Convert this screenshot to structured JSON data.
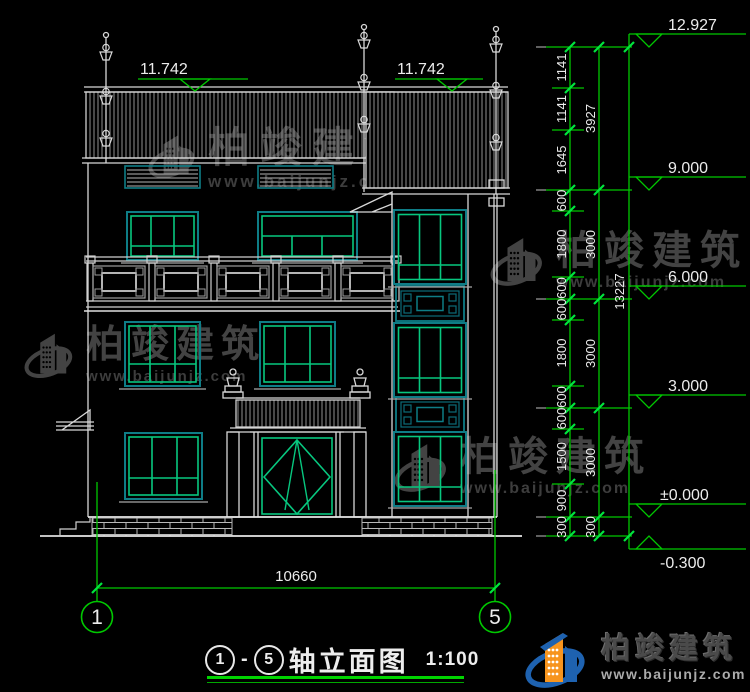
{
  "page": {
    "background": "#000000"
  },
  "drawing": {
    "levels": [
      "12.927",
      "9.000",
      "6.000",
      "3.000",
      "±0.000",
      "-0.300"
    ],
    "roof_level_left": "11.742",
    "roof_level_right": "11.742",
    "chain_inner": [
      "1141",
      "1141",
      "1645",
      "600",
      "1800",
      "600",
      "600",
      "1800",
      "600",
      "600",
      "1500",
      "900",
      "300"
    ],
    "chain_mid": [
      "3927",
      "3000",
      "3000",
      "3000",
      "300"
    ],
    "chain_outer": "13227",
    "overall_width": "10660",
    "axis_left": "1",
    "axis_right": "5"
  },
  "title_block": {
    "axis_start": "1",
    "separator": "-",
    "axis_end": "5",
    "name": "轴立面图",
    "scale": "1:100"
  },
  "watermark": {
    "brand": "柏竣建筑",
    "url": "www.baijunjz.com"
  },
  "footer": {
    "brand": "柏竣建筑",
    "url": "www.baijunjz.com"
  },
  "colors": {
    "dimension_green": "#00c800",
    "line_white": "#d8d8d8",
    "window_frame_teal": "#0e7d86",
    "window_mullion_green": "#07c77f",
    "logo_orange": "#f7941d",
    "logo_blue": "#1e62b0",
    "watermark_gray": "#777777"
  }
}
